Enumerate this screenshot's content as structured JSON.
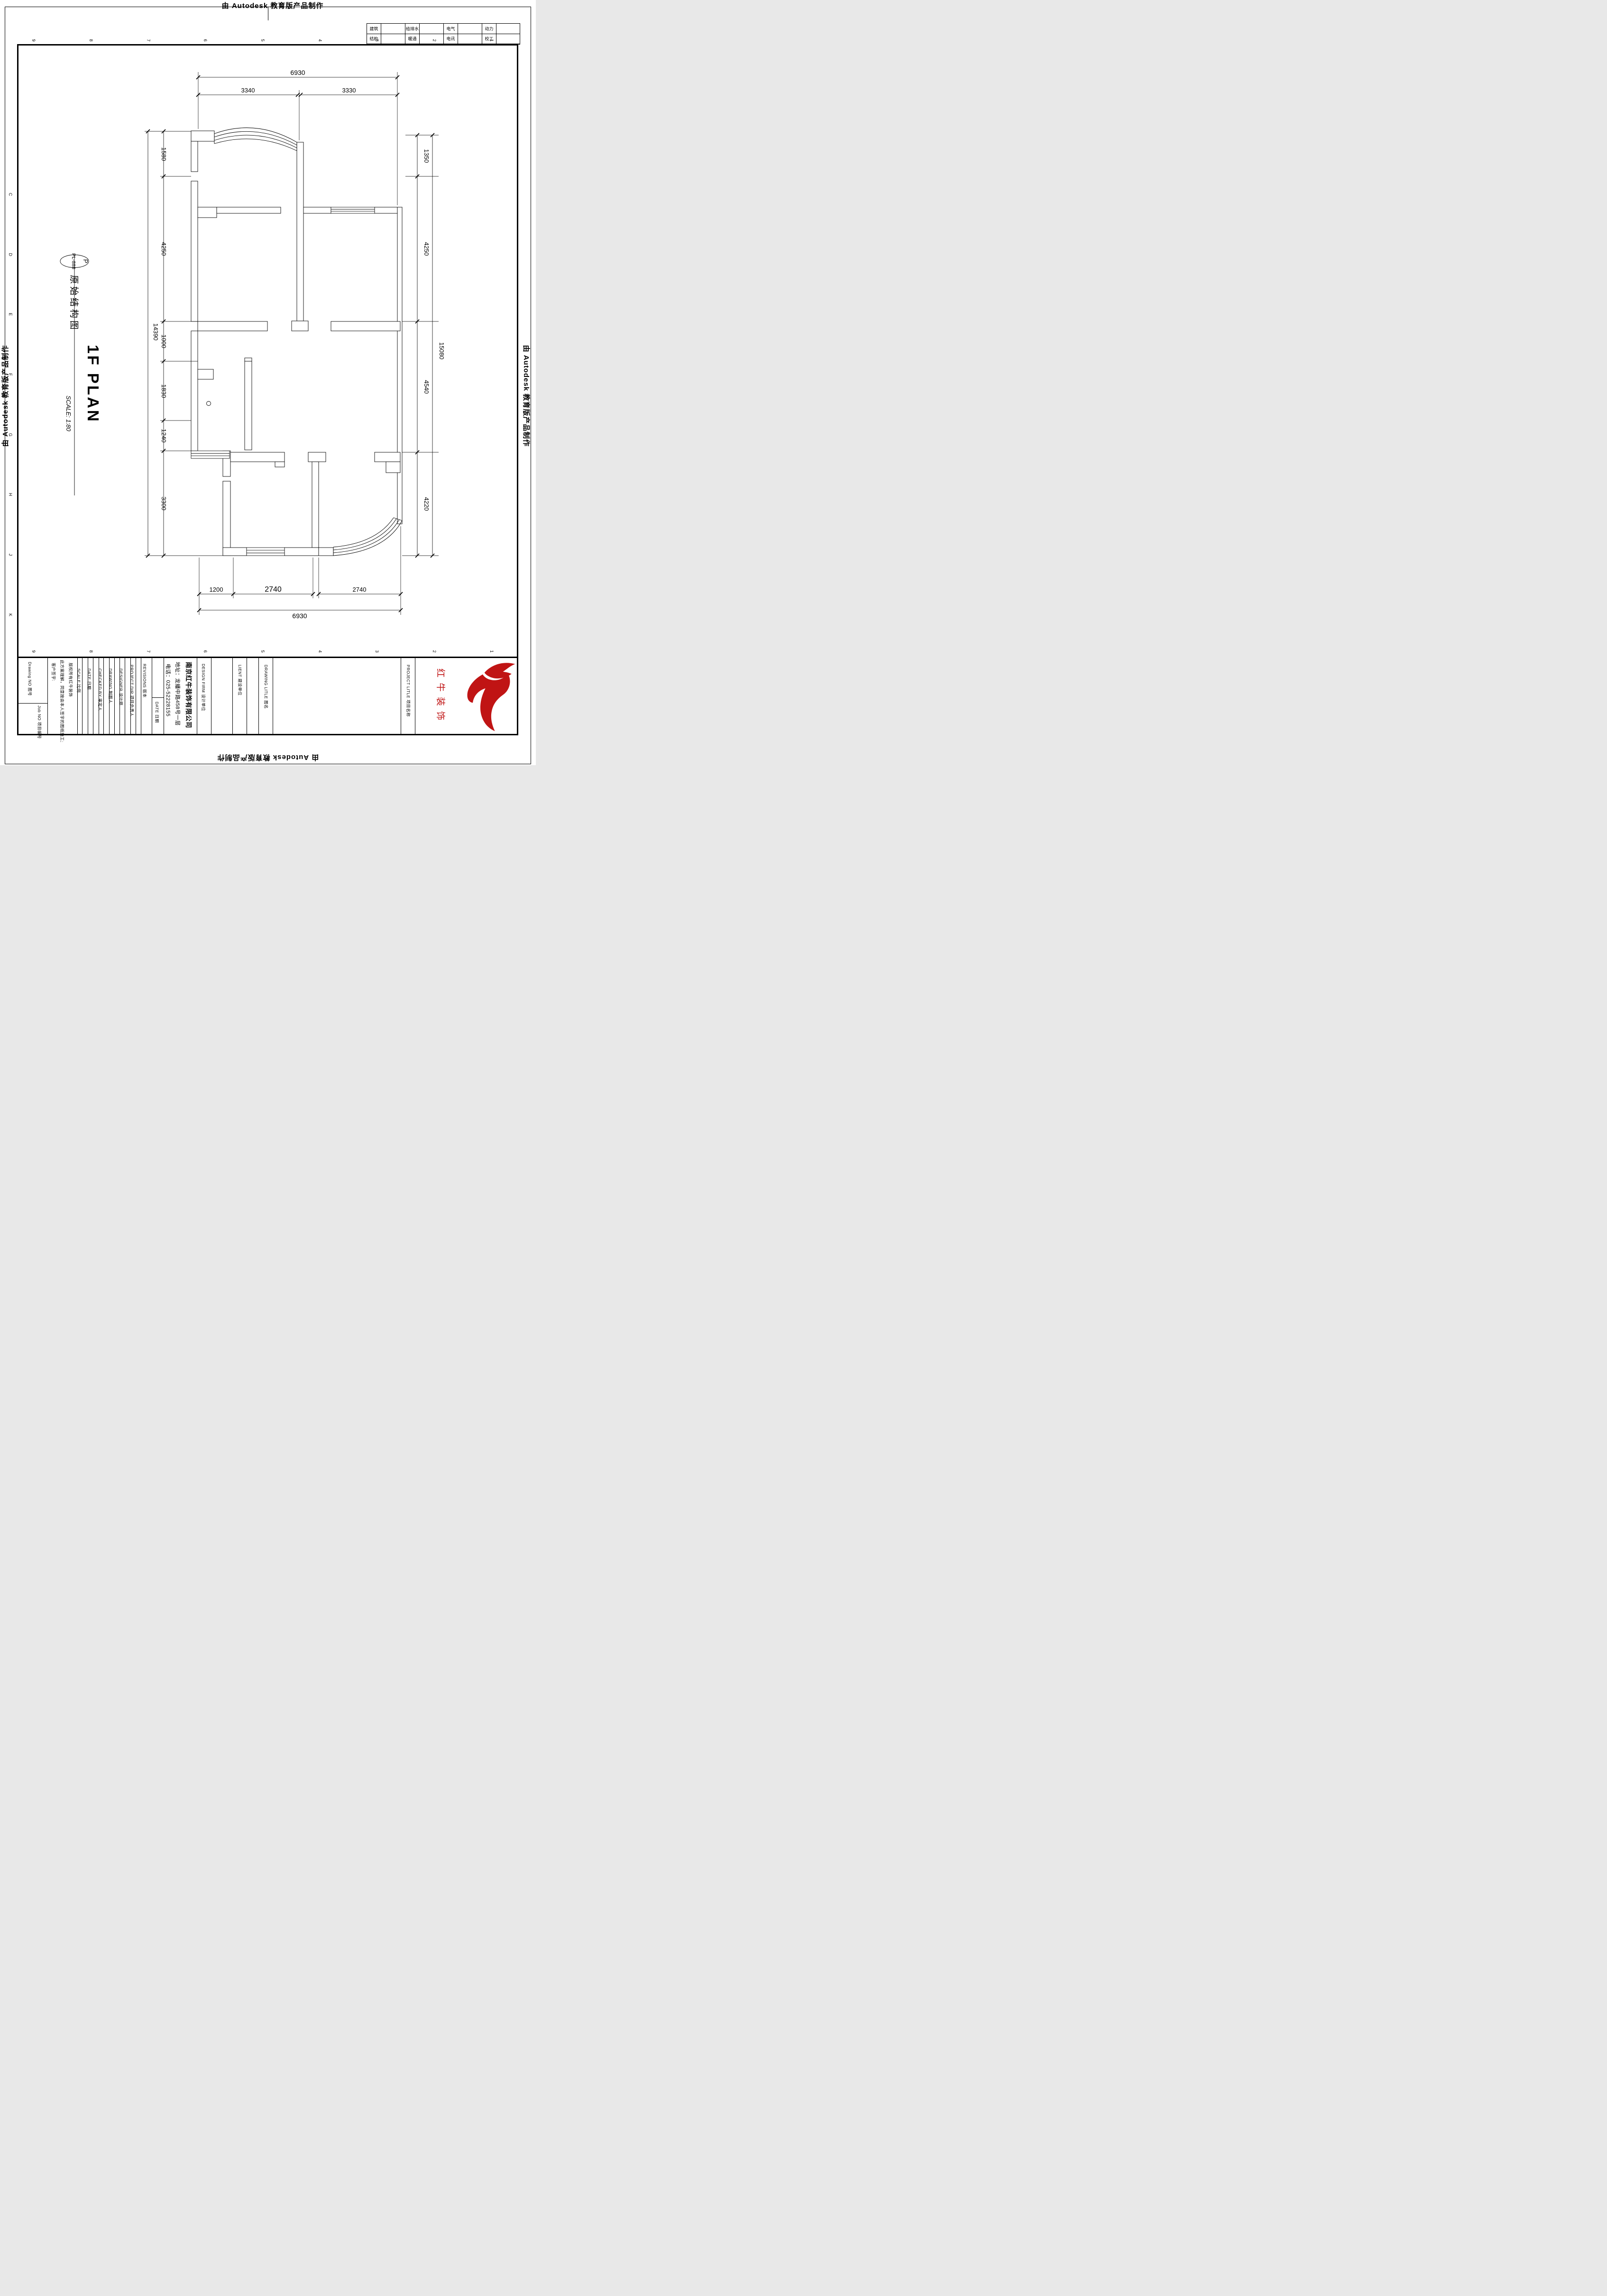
{
  "watermark": {
    "text": "由 Autodesk 教育版产品制作"
  },
  "disciplines": {
    "row1_labels": [
      "建筑",
      "给排水",
      "电气",
      "动力"
    ],
    "row2_labels": [
      "结构",
      "暖通",
      "电讯",
      "校工"
    ]
  },
  "grid_refs": {
    "numbers": [
      "9",
      "8",
      "7",
      "6",
      "5",
      "4",
      "3",
      "2",
      "1"
    ],
    "letters": [
      "C",
      "D",
      "E",
      "F",
      "G",
      "H",
      "J",
      "K"
    ]
  },
  "title_bubble": {
    "letter": "P",
    "code": "PL-888"
  },
  "drawing_title": {
    "cn": "原始结构图",
    "en": "1F PLAN",
    "scale": "SCALE: 1:80"
  },
  "dims": {
    "top": {
      "overall": "6930",
      "segments": [
        "3340",
        "3330"
      ]
    },
    "bottom": {
      "overall": "6930",
      "segments": [
        "1200",
        "2740",
        "2740"
      ]
    },
    "left": {
      "overall": "14390",
      "segments": [
        "1580",
        "4250",
        "1000",
        "1830",
        "1240",
        "3300"
      ]
    },
    "right": {
      "overall": "15080",
      "segments": [
        "1350",
        "4250",
        "4540",
        "4220"
      ]
    }
  },
  "title_block": {
    "drawing_no_label": "Drawing NO  图号",
    "job_no_label": "Job NO  项目编号",
    "client_sign_label": "客户签字:",
    "agreement_text": "此方案理解，同意按由本人签字的图纸施工;",
    "copyright_text": "版权所有红牛装饰",
    "fields": [
      {
        "label": "SCALE  比例"
      },
      {
        "label": "DATE  日期"
      },
      {
        "label": "CHECKED BY  审定人"
      },
      {
        "label": "DRAWING  制图人"
      },
      {
        "label": "DESIGNER  设计师"
      },
      {
        "label": "PROJECT DIR  项目负责人"
      }
    ],
    "revisions_label": "REVISIONS  版本",
    "revisions_date_label": "DATE  日期",
    "company": {
      "name": "南京红牛装饰有限公司",
      "address": "地址：龙蟠中路458号一层",
      "phone": "电话：025-52228155"
    },
    "design_firm_label": "DESIGN FIRM  设计单位",
    "client_label": "LIENT  建设单位",
    "drawing_title_label": "DRAWING LITLE  图名",
    "project_title_label": "PROJECT LITLE  项目名称",
    "logo": {
      "text": "红牛装饰",
      "color": "#c01414"
    }
  }
}
